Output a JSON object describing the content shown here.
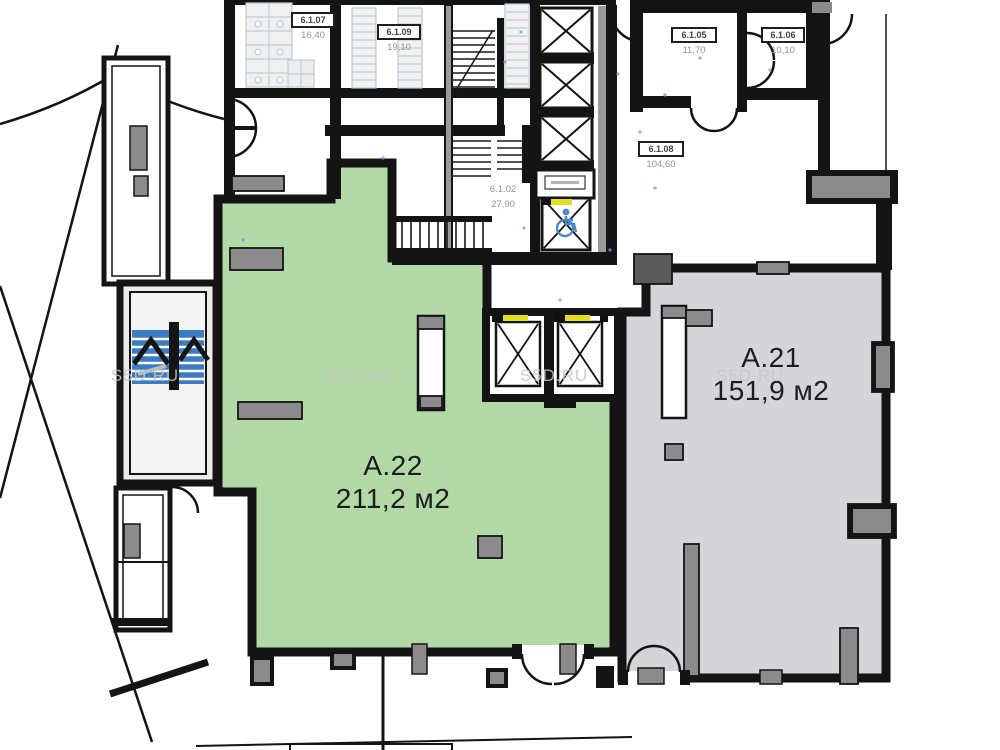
{
  "watermark": {
    "text": "S5D.RU",
    "color": "#c6c6c6"
  },
  "units": [
    {
      "name": "А.22",
      "area": "211,2 м2",
      "fill": "#b3d9a7"
    },
    {
      "name": "А.21",
      "area": "151,9 м2",
      "fill": "#d5d5d7"
    }
  ],
  "rooms": [
    {
      "id": "6.1.07",
      "area": "16,40"
    },
    {
      "id": "6.1.09",
      "area": "19,10"
    },
    {
      "id": "6.1.05",
      "area": "11,70"
    },
    {
      "id": "6.1.06",
      "area": "10,10"
    },
    {
      "id": "6.1.08",
      "area": "104,60"
    },
    {
      "id": "6.1.02",
      "area": "27,90"
    }
  ],
  "colors": {
    "wall_black": "#141414",
    "unit_a22_fill": "#b3d9a7",
    "unit_a21_fill": "#d5d5d7",
    "column_gray": "#8b8b8b",
    "escalator_blue": "#3b7cc4",
    "accent_yellow": "#e3df1f",
    "wheelchair_blue": "#4d86cc",
    "watermark_gray": "#c6c6c6"
  },
  "icons": [
    {
      "name": "wheelchair-icon"
    },
    {
      "name": "elevator-cross-icon"
    },
    {
      "name": "door-arc-icon"
    },
    {
      "name": "stair-treads-icon"
    },
    {
      "name": "escalator-icon"
    }
  ]
}
